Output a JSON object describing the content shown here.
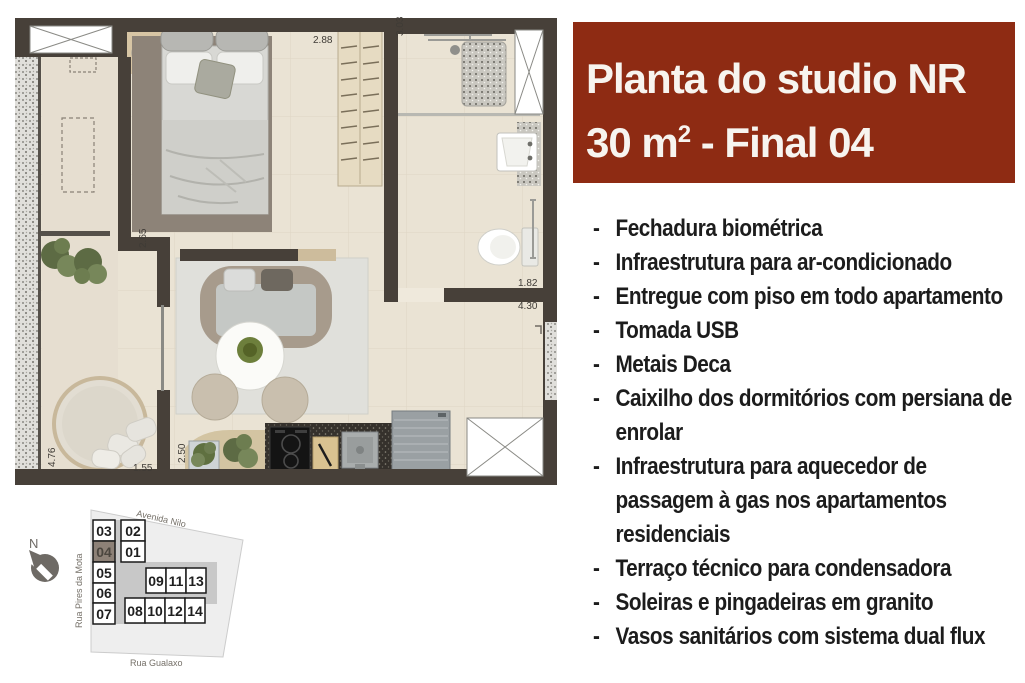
{
  "accent_color": "#8e2b13",
  "wall_color": "#474039",
  "floor_color": "#eae3d4",
  "title": {
    "line1": "Planta do studio NR",
    "area_value": "30 m",
    "area_sup": "2",
    "line2_suffix": " - Final 04"
  },
  "features": {
    "bullet": "-",
    "items": [
      "Fechadura biométrica",
      "Infraestrutura para ar-condicionado",
      "Entregue com piso em todo apartamento",
      "Tomada USB",
      "Metais Deca",
      "Caixilho dos dormitórios com persiana de enrolar",
      "Infraestrutura para aquecedor de passagem à gas nos apartamentos residenciais",
      "Terraço técnico para condensadora",
      "Soleiras e pingadeiras em granito",
      "Vasos sanitários com sistema dual flux"
    ]
  },
  "floor_plan": {
    "dimensions": {
      "bedroom_width": "2.88",
      "bath_length": "3.03",
      "bedroom_length": "2.65",
      "bath_width": "1.82",
      "living_width": "4.30",
      "terrace_length": "4.76",
      "terrace_width": "1.55",
      "kitchen_depth": "2.50"
    }
  },
  "site_plan": {
    "north_label": "N",
    "streets": {
      "top": "Avenida Nilo",
      "left": "Rua Pires da Mota",
      "bottom": "Rua Gualaxo"
    },
    "highlighted_unit": "04",
    "units": [
      "03",
      "04",
      "05",
      "06",
      "07",
      "02",
      "01",
      "09",
      "11",
      "13",
      "08",
      "10",
      "12",
      "14"
    ]
  }
}
